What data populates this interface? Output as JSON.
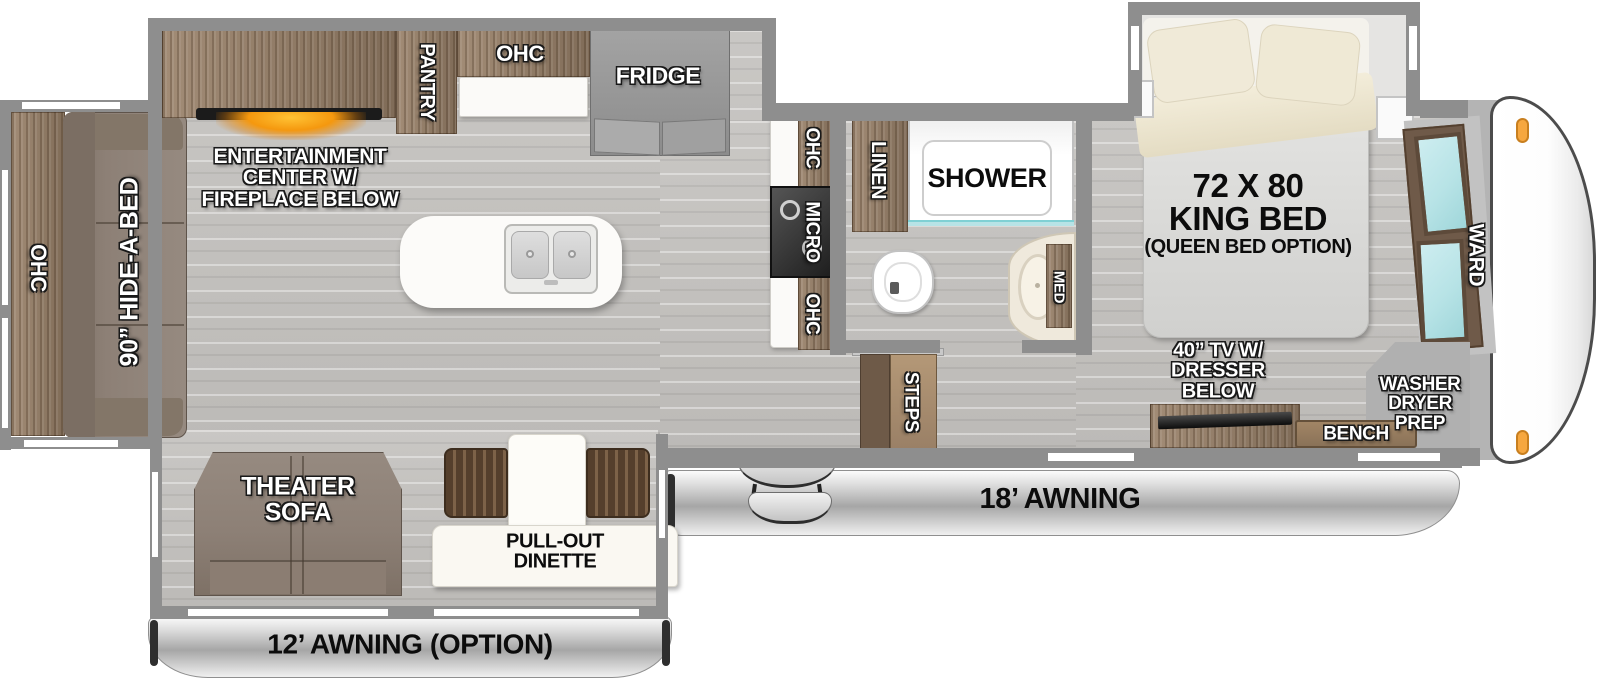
{
  "colors": {
    "wall": "#8e8e8e",
    "floor1": "#c9c7c4",
    "floor2": "#bcbab7",
    "wood1": "#a28c76",
    "wood2": "#806c58",
    "sofa": "#8d8076",
    "teal": "#b7e3e6",
    "glow": "#f5980e",
    "marker": "#f6a73f"
  },
  "plan": {
    "rear": {
      "ohc": "OHC",
      "hide_a_bed": "90” HIDE-A-BED"
    },
    "living": {
      "entertainment": "ENTERTAINMENT\nCENTER W/\nFIREPLACE BELOW",
      "pantry": "PANTRY",
      "ohc": "OHC",
      "fridge": "FRIDGE"
    },
    "kitchen": {
      "ohc_top": "OHC",
      "micro": "MICRO",
      "ohc_bottom": "OHC"
    },
    "bath": {
      "linen": "LINEN",
      "shower": "SHOWER",
      "med": "MED",
      "steps": "STEPS"
    },
    "bedroom": {
      "bed_size": "72 X 80",
      "bed_type": "KING BED",
      "bed_option": "(QUEEN BED OPTION)",
      "ward": "WARD",
      "tv": "40” TV W/\nDRESSER\nBELOW",
      "bench": "BENCH",
      "washer": "WASHER\nDRYER\nPREP"
    },
    "door_side": {
      "theater_sofa": "THEATER\nSOFA",
      "dinette": "PULL-OUT\nDINETTE"
    },
    "awnings": {
      "awning_18": "18’ AWNING",
      "awning_12": "12’ AWNING (OPTION)"
    }
  }
}
